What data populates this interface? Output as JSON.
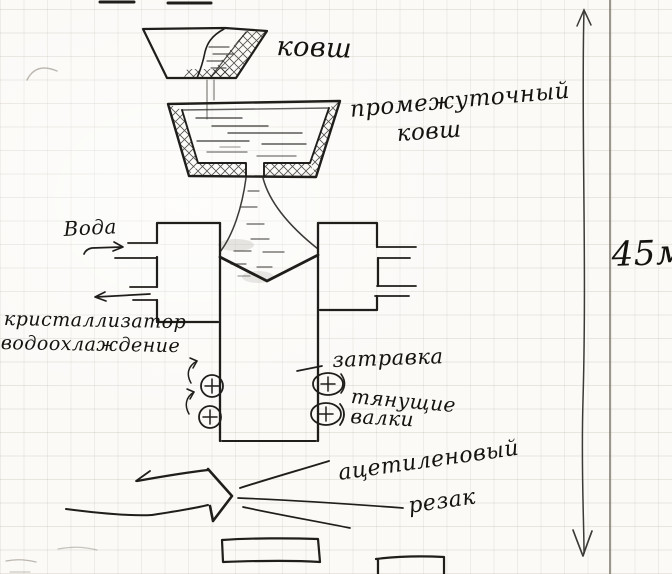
{
  "labels": {
    "ladle": "ковш",
    "tundish_line1": "промежуточный",
    "tundish_line2": "ковш",
    "water": "Вода",
    "mold_line1": "кристаллизатор",
    "mold_line2": "водоохлаждение",
    "dummy_bar": "затравка",
    "rollers_line1": "тянущие",
    "rollers_line2": "валки",
    "cutter_line1": "ацетиленовый",
    "cutter_line2": "резак",
    "height_dimension": "45м"
  },
  "colors": {
    "ink": "#201e1b",
    "pencil": "#8a8378",
    "paper": "#fbfaf7",
    "grid_line": "#d8d1c5"
  }
}
